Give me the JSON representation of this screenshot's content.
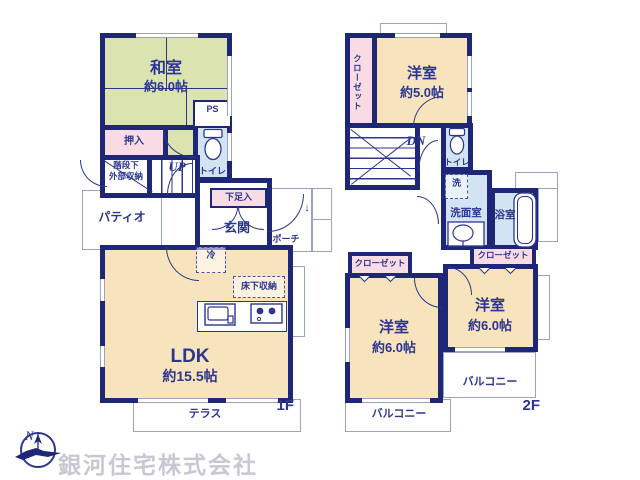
{
  "colors": {
    "wall": "#1e2678",
    "ink": "#2c3590",
    "tatami": "#dbe3b1",
    "cream": "#f7e3bc",
    "pink": "#f9dce3",
    "aqua": "#d2e4f4",
    "outline": "#9aa2c8",
    "watermark": "#c8c8d2"
  },
  "floor1": {
    "floor_label": "1F",
    "washitsu": {
      "name": "和室",
      "size": "約6.0帖"
    },
    "oshiire": "押入",
    "ps": "PS",
    "toilet": "トイレ",
    "stair_storage": {
      "line1": "階段下",
      "line2": "外部収納"
    },
    "up": "UP",
    "patio": "パティオ",
    "shoebox": "下足入",
    "genkan": "玄関",
    "porch": "ポーチ",
    "entry_arrow": "↓",
    "fridge": "冷",
    "floor_storage": "床下収納",
    "ldk": {
      "name": "LDK",
      "size": "約15.5帖"
    },
    "terrace": "テラス"
  },
  "floor2": {
    "floor_label": "2F",
    "closet_nw": "クローゼット",
    "bedroom5": {
      "name": "洋室",
      "size": "約5.0帖"
    },
    "dn": "DN",
    "toilet": "トイレ",
    "laundry": "洗",
    "washroom": "洗面室",
    "bathroom": "浴室",
    "closet_w": "クローゼット",
    "closet_e": "クローゼット",
    "bedroom6w": {
      "name": "洋室",
      "size": "約6.0帖"
    },
    "bedroom6e": {
      "name": "洋室",
      "size": "約6.0帖"
    },
    "balcony_e": "バルコニー",
    "balcony_w": "バルコニー"
  },
  "branding": {
    "company": "銀河住宅株式会社",
    "compass_north": "N"
  }
}
